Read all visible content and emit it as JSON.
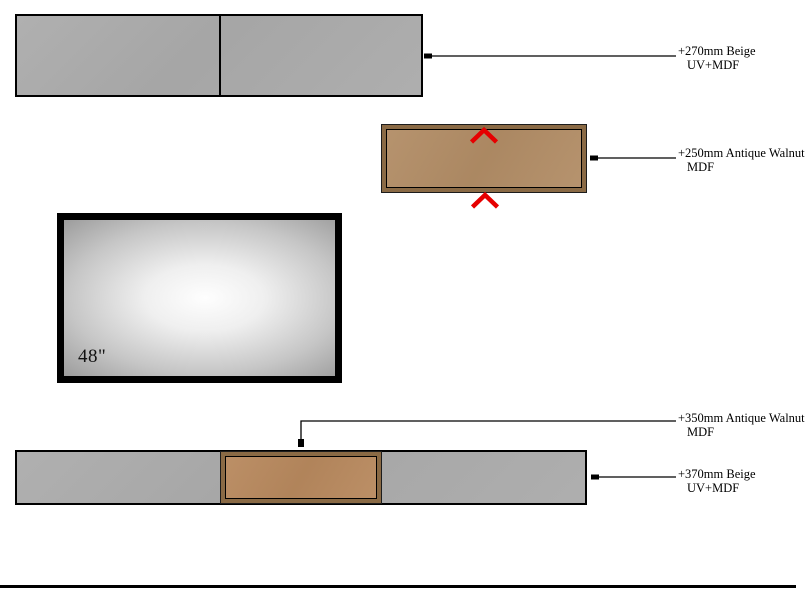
{
  "drawing": {
    "tv": {
      "size_label": "48\""
    },
    "annotations": [
      {
        "id": "270",
        "line1": "+270mm Beige",
        "line2": "UV+MDF"
      },
      {
        "id": "250",
        "line1": "+250mm Antique Walnut",
        "line2": "MDF"
      },
      {
        "id": "350",
        "line1": "+350mm Antique Walnut",
        "line2": "MDF"
      },
      {
        "id": "370",
        "line1": "+370mm Beige",
        "line2": "UV+MDF"
      }
    ],
    "colors": {
      "panel_gray": "#ababab",
      "walnut_frame": "#8a6a45",
      "walnut_face": "#b28d66",
      "walnut_face_bottom": "#b8895e",
      "marker_red": "#e60000",
      "line_black": "#000000"
    }
  }
}
